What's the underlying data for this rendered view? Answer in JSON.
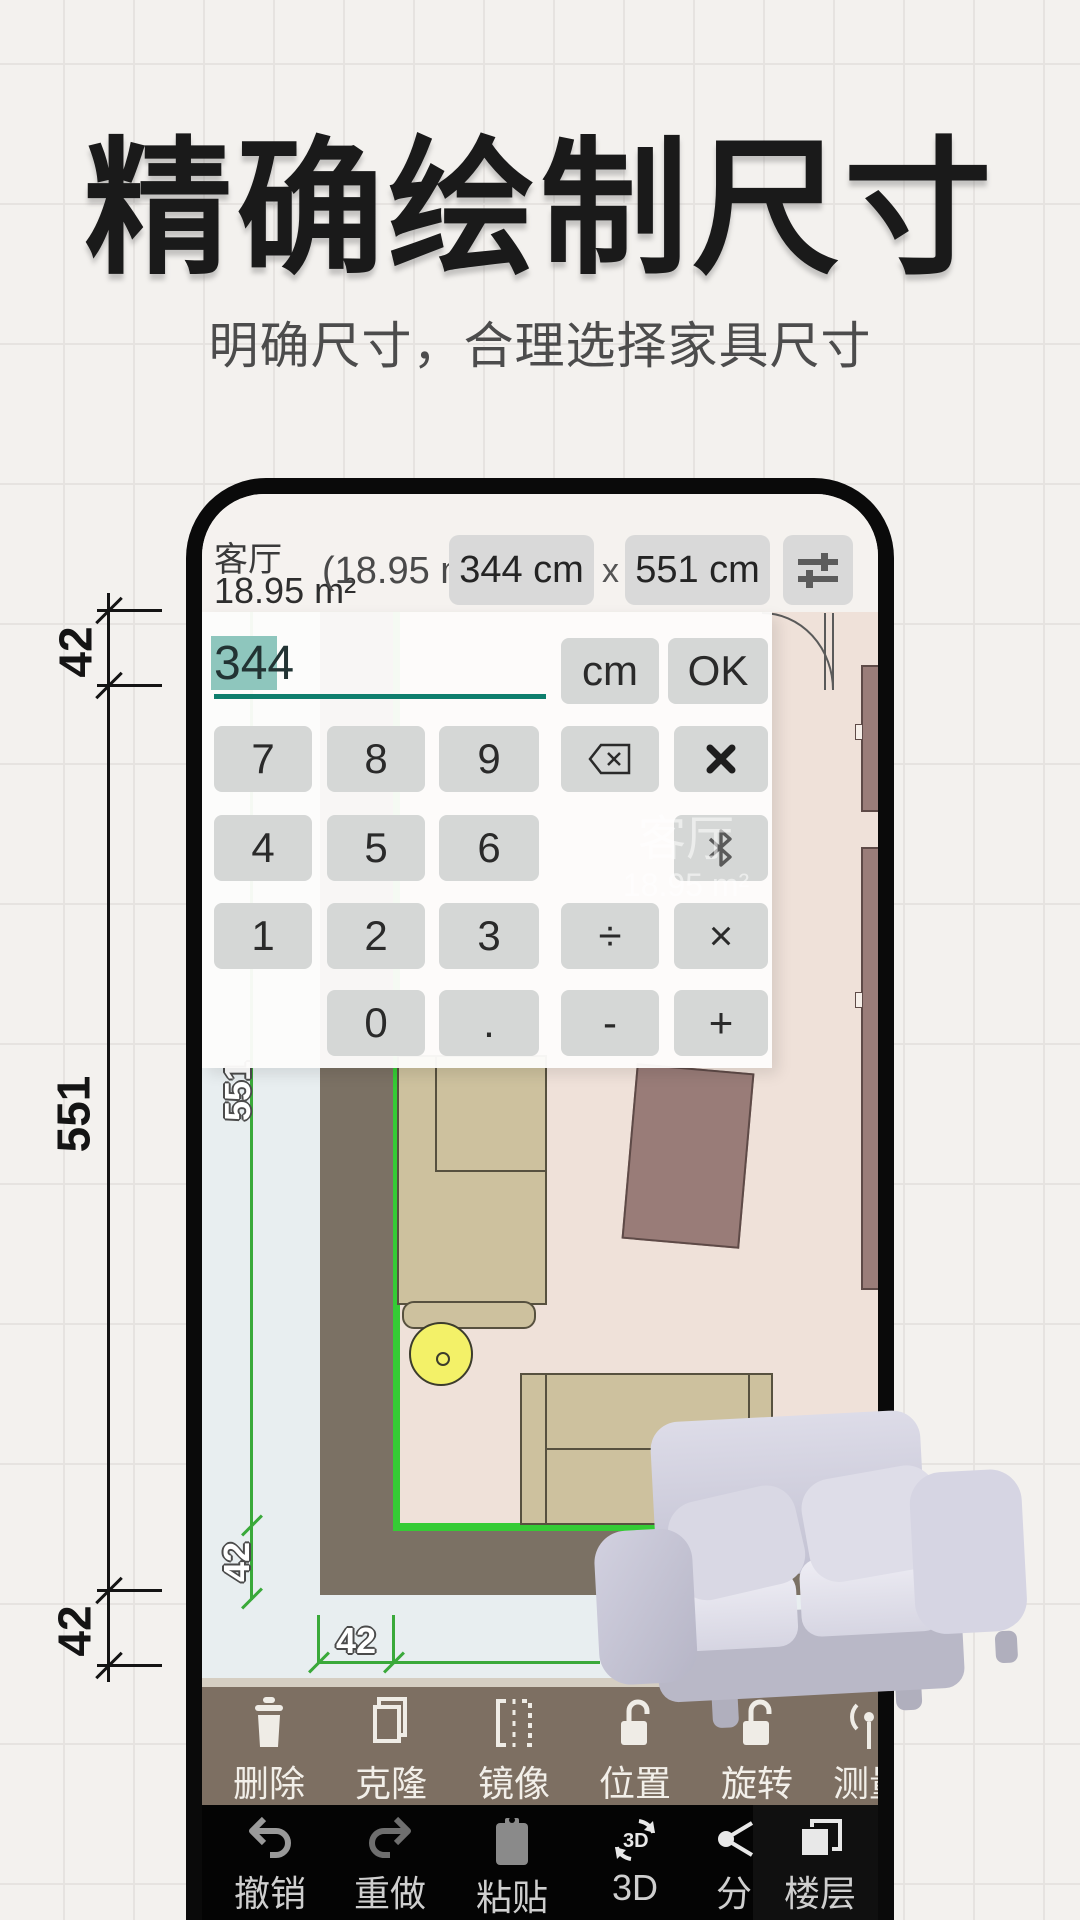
{
  "hero": {
    "title": "精确绘制尺寸",
    "subtitle": "明确尺寸，合理选择家具尺寸"
  },
  "left_dimension": {
    "top": "42",
    "middle": "551",
    "bottom": "42"
  },
  "phone": {
    "top_bar": {
      "room_name": "客厅",
      "room_area": "18.95 m²",
      "area_hint": "(18.95 m²)",
      "width_button": "344 cm",
      "separator": "x",
      "length_button": "551 cm",
      "settings_icon": "tune-sliders-icon"
    },
    "calculator": {
      "input_value": "344",
      "unit_button": "cm",
      "confirm_button": "OK",
      "keys": [
        [
          "7",
          "8",
          "9",
          "",
          ""
        ],
        [
          "4",
          "5",
          "6",
          "",
          ""
        ],
        [
          "1",
          "2",
          "3",
          "÷",
          "×"
        ],
        [
          "",
          "0",
          ".",
          "-",
          "+"
        ]
      ],
      "icon_keys": {
        "backspace": "backspace-icon",
        "close": "x-close-icon",
        "bluetooth": "bluetooth-icon"
      },
      "accent_color": "#0e7e6d",
      "selection_color": "#8ec6bd"
    },
    "floor_plan": {
      "watermark_room_name": "客厅",
      "watermark_room_area": "18.95 m²",
      "wall_length_label": "551",
      "thickness_label_v": "42",
      "thickness_label_h": "42",
      "colors": {
        "outside": "#e8eef0",
        "floor": "#efe1d9",
        "wall": "#7b7164",
        "selection_green": "#35cb35",
        "dimension_green": "#3aa93a",
        "sofa_tan": "#cdc19e",
        "rug_mauve": "#997c78",
        "lamp_yellow": "#f3f168"
      }
    },
    "toolbar": {
      "items": [
        {
          "label": "删除",
          "icon": "trash-icon"
        },
        {
          "label": "克隆",
          "icon": "clone-icon"
        },
        {
          "label": "镜像",
          "icon": "mirror-flip-icon"
        },
        {
          "label": "位置",
          "icon": "unlock-icon"
        },
        {
          "label": "旋转",
          "icon": "unlock-icon"
        },
        {
          "label": "测量",
          "icon": "measure-signal-icon"
        }
      ]
    },
    "navbar": {
      "items": [
        {
          "label": "撤销",
          "icon": "undo-icon"
        },
        {
          "label": "重做",
          "icon": "redo-icon"
        },
        {
          "label": "粘贴",
          "icon": "paste-clipboard-icon"
        },
        {
          "label": "3D",
          "icon": "rotate-3d-icon"
        },
        {
          "label": "分",
          "icon": "share-icon"
        },
        {
          "label": "楼层",
          "icon": "layers-icon"
        }
      ]
    }
  }
}
